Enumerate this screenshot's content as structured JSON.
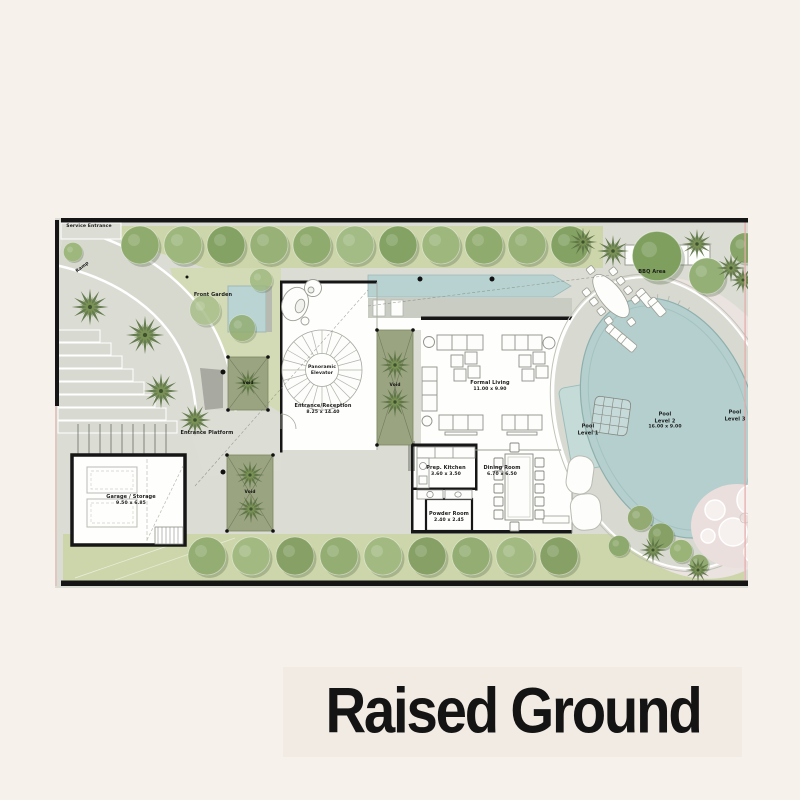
{
  "title": "Raised Ground",
  "plan": {
    "labels": {
      "service_entrance": "Service Entrance",
      "ramp": "Ramp",
      "front_garden": "Front Garden",
      "entrance_platform": "Entrance Platform",
      "bbq_area": "BBQ Area",
      "void": "Void",
      "panoramic_elevator": "Panoramic Elevator"
    },
    "rooms": {
      "entrance_reception": {
        "name": "Entrance/Reception",
        "dims": "8.25 x 14.40"
      },
      "garage": {
        "name": "Garage / Storage",
        "dims": "9.50 x 6.85"
      },
      "formal_living": {
        "name": "Formal Living",
        "dims": "11.00 x 9.90"
      },
      "prep_kitchen": {
        "name": "Prep. Kitchen",
        "dims": "3.60 x 3.50"
      },
      "dining_room": {
        "name": "Dining Room",
        "dims": "6.70 x 6.50"
      },
      "powder_room": {
        "name": "Powder Room",
        "dims": "2.40 x 2.45"
      },
      "pool_level_1": {
        "name": "Pool",
        "level": "Level 1"
      },
      "pool_level_2": {
        "name": "Pool",
        "level": "Level 2",
        "dims": "16.00 x 9.00"
      },
      "pool_level_3": {
        "name": "Pool",
        "level": "Level 3"
      }
    },
    "colors": {
      "water": "#b5d0ce",
      "grass": "#ccd5a9",
      "paving": "#dbddd4",
      "wall": "#161616",
      "accent_pink": "#e7a9a9"
    }
  }
}
